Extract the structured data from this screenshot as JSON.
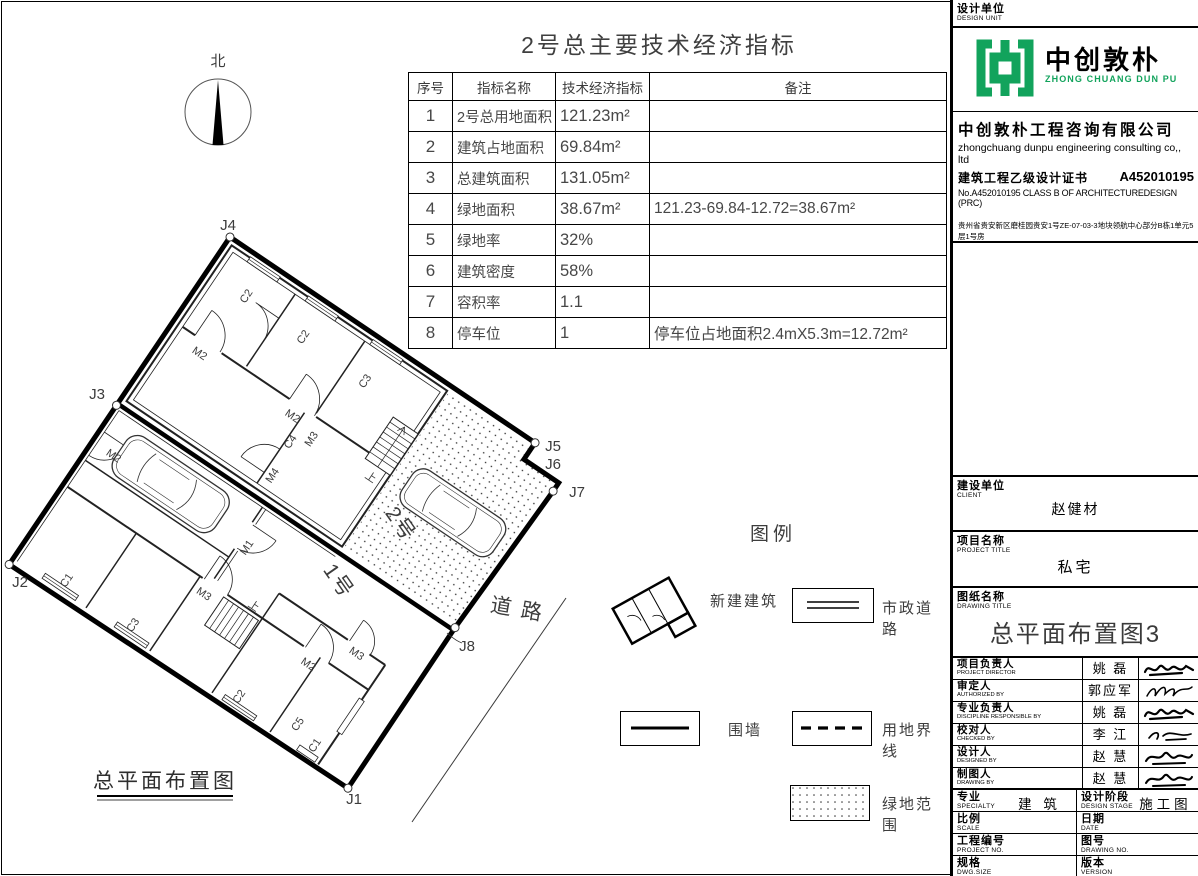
{
  "brand_green": "#12a35c",
  "north_label": "北",
  "indicator_table": {
    "title": "2号总主要技术经济指标",
    "headers": [
      "序号",
      "指标名称",
      "技术经济指标",
      "备注"
    ],
    "rows": [
      {
        "no": "1",
        "name": "2号总用地面积",
        "value": "121.23m²",
        "note": ""
      },
      {
        "no": "2",
        "name": "建筑占地面积",
        "value": "69.84m²",
        "note": ""
      },
      {
        "no": "3",
        "name": "总建筑面积",
        "value": "131.05m²",
        "note": ""
      },
      {
        "no": "4",
        "name": "绿地面积",
        "value": "38.67m²",
        "note": "121.23-69.84-12.72=38.67m²"
      },
      {
        "no": "5",
        "name": "绿地率",
        "value": "32%",
        "note": ""
      },
      {
        "no": "6",
        "name": "建筑密度",
        "value": "58%",
        "note": ""
      },
      {
        "no": "7",
        "name": "容积率",
        "value": "1.1",
        "note": ""
      },
      {
        "no": "8",
        "name": "停车位",
        "value": "1",
        "note": "停车位占地面积2.4mX5.3m=12.72m²"
      }
    ]
  },
  "site_plan": {
    "title": "总平面布置图",
    "road_label": "道 路",
    "building1_label": "1号",
    "building2_label": "2号",
    "j_labels": [
      {
        "t": "J4",
        "x": 228,
        "y": 230
      },
      {
        "t": "J3",
        "x": 97,
        "y": 399
      },
      {
        "t": "J2",
        "x": 20,
        "y": 587
      },
      {
        "t": "J1",
        "x": 354,
        "y": 804
      },
      {
        "t": "J8",
        "x": 467,
        "y": 651
      },
      {
        "t": "J7",
        "x": 577,
        "y": 497
      },
      {
        "t": "J6",
        "x": 553,
        "y": 469
      },
      {
        "t": "J5",
        "x": 553,
        "y": 451
      }
    ],
    "room_labels": [
      {
        "t": "C2",
        "x": 50,
        "y": 40,
        "r": -90
      },
      {
        "t": "C2",
        "x": 120,
        "y": 42,
        "r": -90
      },
      {
        "t": "C3",
        "x": 196,
        "y": 44,
        "r": -90
      },
      {
        "t": "M2",
        "x": 40,
        "y": 117,
        "r": 0
      },
      {
        "t": "M2",
        "x": 152,
        "y": 117,
        "r": 0
      },
      {
        "t": "M3",
        "x": 184,
        "y": 122,
        "r": -90
      },
      {
        "t": "C4",
        "x": 168,
        "y": 136,
        "r": -90
      },
      {
        "t": "M4",
        "x": 172,
        "y": 174,
        "r": -90
      },
      {
        "t": "上",
        "x": 251,
        "y": 124,
        "r": 0
      },
      {
        "t": "M2",
        "x": 26,
        "y": 250,
        "r": 0
      },
      {
        "t": "M1",
        "x": 191,
        "y": 248,
        "r": -90
      },
      {
        "t": "M3",
        "x": 178,
        "y": 314,
        "r": 0
      },
      {
        "t": "M2",
        "x": 304,
        "y": 314,
        "r": 0
      },
      {
        "t": "M3",
        "x": 338,
        "y": 278,
        "r": 0
      },
      {
        "t": "上",
        "x": 226,
        "y": 296,
        "r": 0
      },
      {
        "t": "C1",
        "x": 60,
        "y": 376,
        "r": -90
      },
      {
        "t": "C3",
        "x": 140,
        "y": 376,
        "r": -90
      },
      {
        "t": "C2",
        "x": 268,
        "y": 376,
        "r": -90
      },
      {
        "t": "C5",
        "x": 332,
        "y": 366,
        "r": -90
      },
      {
        "t": "C1",
        "x": 358,
        "y": 374,
        "r": -90
      }
    ]
  },
  "legend": {
    "title": "图例",
    "items": [
      {
        "label": "新建建筑"
      },
      {
        "label": "市政道路"
      },
      {
        "label": "围墙"
      },
      {
        "label": "用地界线"
      },
      {
        "label": "绿地范围"
      }
    ]
  },
  "title_block": {
    "design_unit_label": "设计单位",
    "design_unit_label_en": "DESIGN UNIT",
    "logo": {
      "name_cn": "中创敦朴",
      "name_en": "ZHONG CHUANG DUN PU"
    },
    "company": {
      "name_cn": "中创敦朴工程咨询有限公司",
      "name_en": "zhongchuang dunpu engineering consulting co,, ltd",
      "cert_cn": "建筑工程乙级设计证书",
      "cert_no": "A452010195",
      "cert_en": "No.A452010195 CLASS B OF ARCHITECTUREDESIGN (PRC)",
      "address": "贵州省贵安新区磨桂园贵安1号ZE-07-03-3地块领航中心部分B栋1单元5层1号房",
      "email": "E-mail:366317080@qq.com",
      "phone": "电话:15769695522",
      "postcode": "邮编:550003"
    },
    "client": {
      "label": "建设单位",
      "label_en": "CLIENT",
      "value": "赵健材"
    },
    "project": {
      "label": "项目名称",
      "label_en": "PROJECT TITLE",
      "value": "私宅"
    },
    "drawing": {
      "label": "图纸名称",
      "label_en": "DRAWING TITLE",
      "value": "总平面布置图3"
    },
    "personnel": [
      {
        "label": "项目负责人",
        "label_en": "PROJECT DIRECTOR",
        "name": "姚 磊"
      },
      {
        "label": "审定人",
        "label_en": "AUTHORIZED BY",
        "name": "郭应军"
      },
      {
        "label": "专业负责人",
        "label_en": "DISCIPLINE RESPONSIBLE BY",
        "name": "姚 磊"
      },
      {
        "label": "校对人",
        "label_en": "CHECKED BY",
        "name": "李 江"
      },
      {
        "label": "设计人",
        "label_en": "DESIGNED BY",
        "name": "赵 慧"
      },
      {
        "label": "制图人",
        "label_en": "DRAWING BY",
        "name": "赵 慧"
      }
    ],
    "meta": [
      {
        "label": "专业",
        "label_en": "SPECIALTY",
        "value": "建 筑",
        "label2": "设计阶段",
        "label2_en": "DESIGN STAGE",
        "value2": "施工图"
      },
      {
        "label": "比例",
        "label_en": "SCALE",
        "value": "",
        "label2": "日期",
        "label2_en": "DATE",
        "value2": ""
      },
      {
        "label": "工程编号",
        "label_en": "PROJECT NO.",
        "value": "",
        "label2": "图号",
        "label2_en": "DRAWING NO.",
        "value2": ""
      },
      {
        "label": "规格",
        "label_en": "DWG.SIZE",
        "value": "",
        "label2": "版本",
        "label2_en": "VERSION",
        "value2": ""
      }
    ]
  }
}
